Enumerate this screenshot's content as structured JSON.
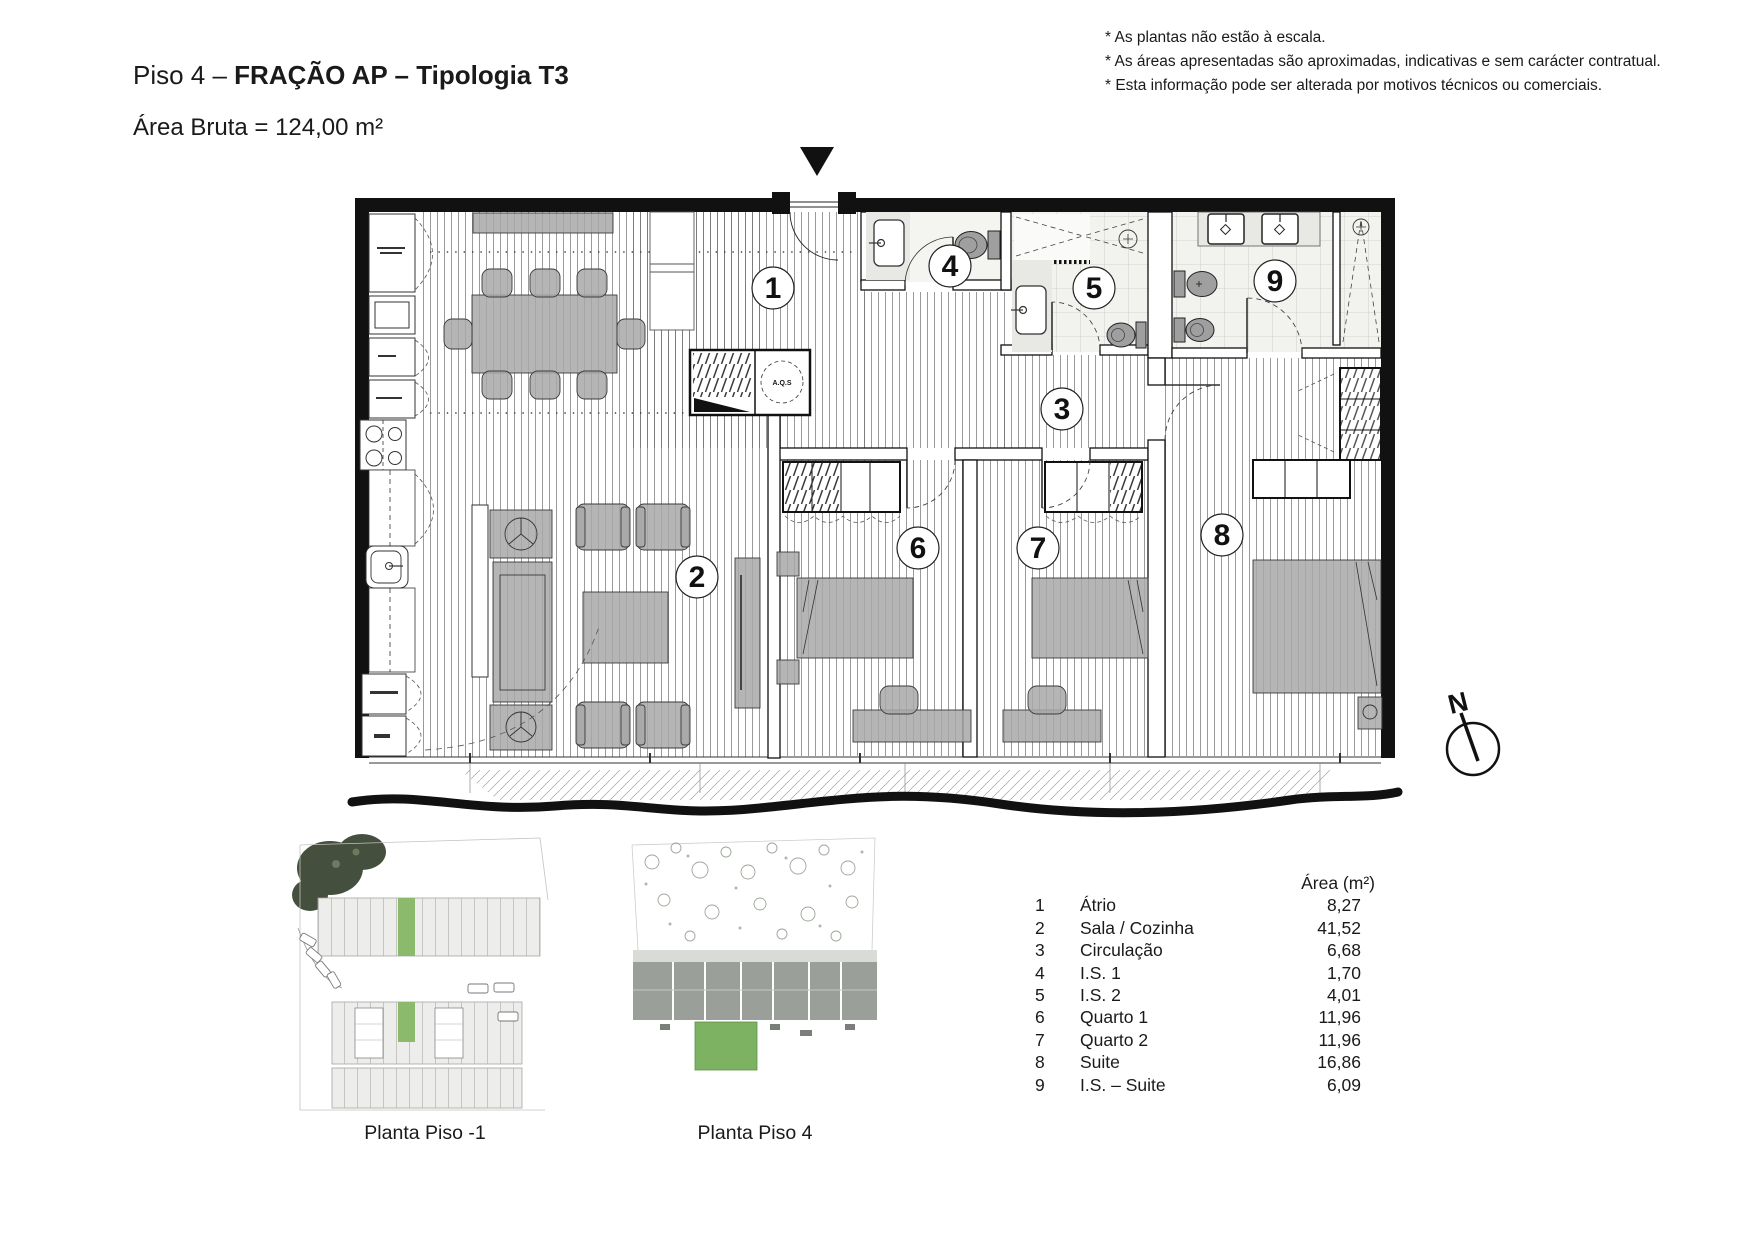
{
  "header": {
    "title_prefix": "Piso 4 – ",
    "title_bold": "FRAÇÃO AP – Tipologia T3",
    "area_line": "Área Bruta = 124,00 m²"
  },
  "notes": [
    "* As plantas não estão à escala.",
    "* As áreas apresentadas são aproximadas, indicativas e sem carácter contratual.",
    "* Esta informação pode ser alterada por motivos técnicos ou comerciais."
  ],
  "plan": {
    "north_label": "N",
    "aqs_label": "A.Q.S"
  },
  "legend": {
    "area_header": "Área (m²)",
    "rows": [
      {
        "num": "1",
        "name": "Átrio",
        "area": "8,27"
      },
      {
        "num": "2",
        "name": "Sala / Cozinha",
        "area": "41,52"
      },
      {
        "num": "3",
        "name": "Circulação",
        "area": "6,68"
      },
      {
        "num": "4",
        "name": "I.S. 1",
        "area": "1,70"
      },
      {
        "num": "5",
        "name": "I.S. 2",
        "area": "4,01"
      },
      {
        "num": "6",
        "name": "Quarto 1",
        "area": "11,96"
      },
      {
        "num": "7",
        "name": "Quarto 2",
        "area": "11,96"
      },
      {
        "num": "8",
        "name": "Suite",
        "area": "16,86"
      },
      {
        "num": "9",
        "name": "I.S. – Suite",
        "area": "6,09"
      }
    ]
  },
  "thumbnails": [
    {
      "caption": "Planta Piso -1"
    },
    {
      "caption": "Planta Piso 4"
    }
  ]
}
